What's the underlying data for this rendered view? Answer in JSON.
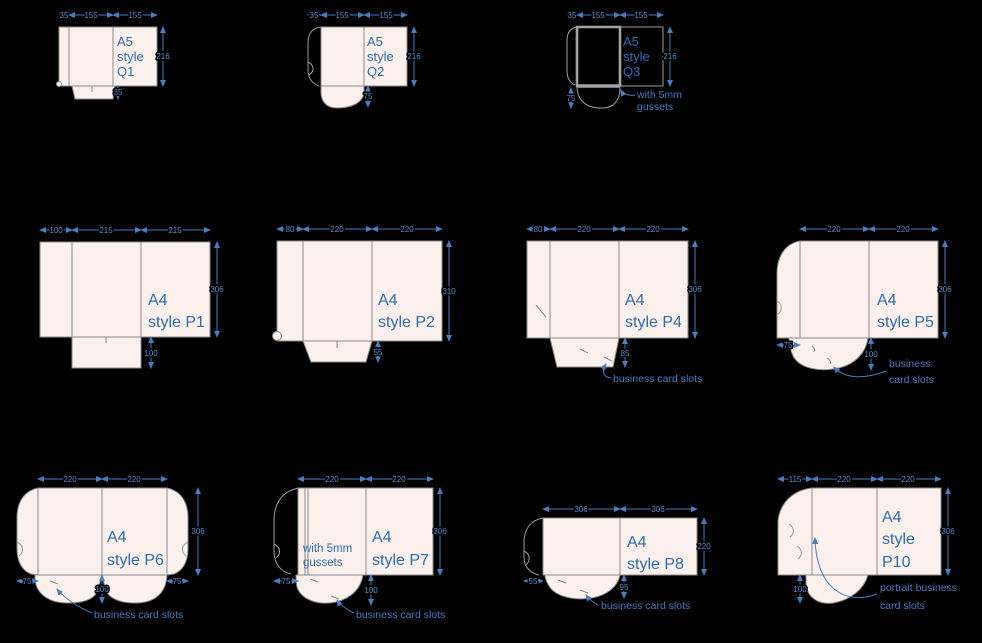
{
  "colors": {
    "background": "#000000",
    "sheet_fill": "#fbf0eb",
    "outline_gray": "#8b8b8b",
    "dimension_blue": "#4a7cc0",
    "label_blue": "#2e6db4"
  },
  "diagrams": {
    "q1": {
      "label": [
        "A5",
        "style",
        "Q1"
      ],
      "top": [
        "35",
        "155",
        "155"
      ],
      "height": "216",
      "pocket": "35"
    },
    "q2": {
      "label": [
        "A5",
        "style",
        "Q2"
      ],
      "top": [
        "35",
        "155",
        "155"
      ],
      "height": "216",
      "pocket": "75"
    },
    "q3": {
      "label": [
        "A5",
        "style",
        "Q3"
      ],
      "top": [
        "35",
        "155",
        "155"
      ],
      "height": "216",
      "pocket": "75",
      "note": [
        "with 5mm",
        "gussets"
      ]
    },
    "p1": {
      "label": [
        "A4",
        "style P1"
      ],
      "top": [
        "100",
        "215",
        "215"
      ],
      "height": "306",
      "pocket": "100"
    },
    "p2": {
      "label": [
        "A4",
        "style P2"
      ],
      "top": [
        "80",
        "220",
        "220"
      ],
      "height": "310",
      "pocket": "55"
    },
    "p4": {
      "label": [
        "A4",
        "style P4"
      ],
      "top": [
        "80",
        "220",
        "220"
      ],
      "height": "306",
      "pocket": "85",
      "ann": "business card slots"
    },
    "p5": {
      "label": [
        "A4",
        "style P5"
      ],
      "top": [
        "220",
        "220"
      ],
      "height": "306",
      "flap": "75",
      "pocket": "100",
      "ann": [
        "business",
        "card slots"
      ]
    },
    "p6": {
      "label": [
        "A4",
        "style P6"
      ],
      "top": [
        "220",
        "220"
      ],
      "height": "306",
      "flap_left": "75",
      "flap_right": "75",
      "pocket": "100",
      "ann": "business card slots"
    },
    "p7": {
      "label": [
        "A4",
        "style P7"
      ],
      "top": [
        "220",
        "220"
      ],
      "height": "306",
      "flap": "75",
      "pocket": "100",
      "note": [
        "with 5mm",
        "gussets"
      ],
      "ann": "business card slots"
    },
    "p8": {
      "label": [
        "A4",
        "style P8"
      ],
      "top": [
        "306",
        "306"
      ],
      "height": "220",
      "flap": "55",
      "pocket": "95",
      "ann": "business card slots"
    },
    "p10": {
      "label": [
        "A4",
        "style",
        "P10"
      ],
      "top": [
        "115",
        "220",
        "220"
      ],
      "height": "306",
      "pocket": "100",
      "ann": [
        "portrait business",
        "card slots"
      ]
    }
  }
}
